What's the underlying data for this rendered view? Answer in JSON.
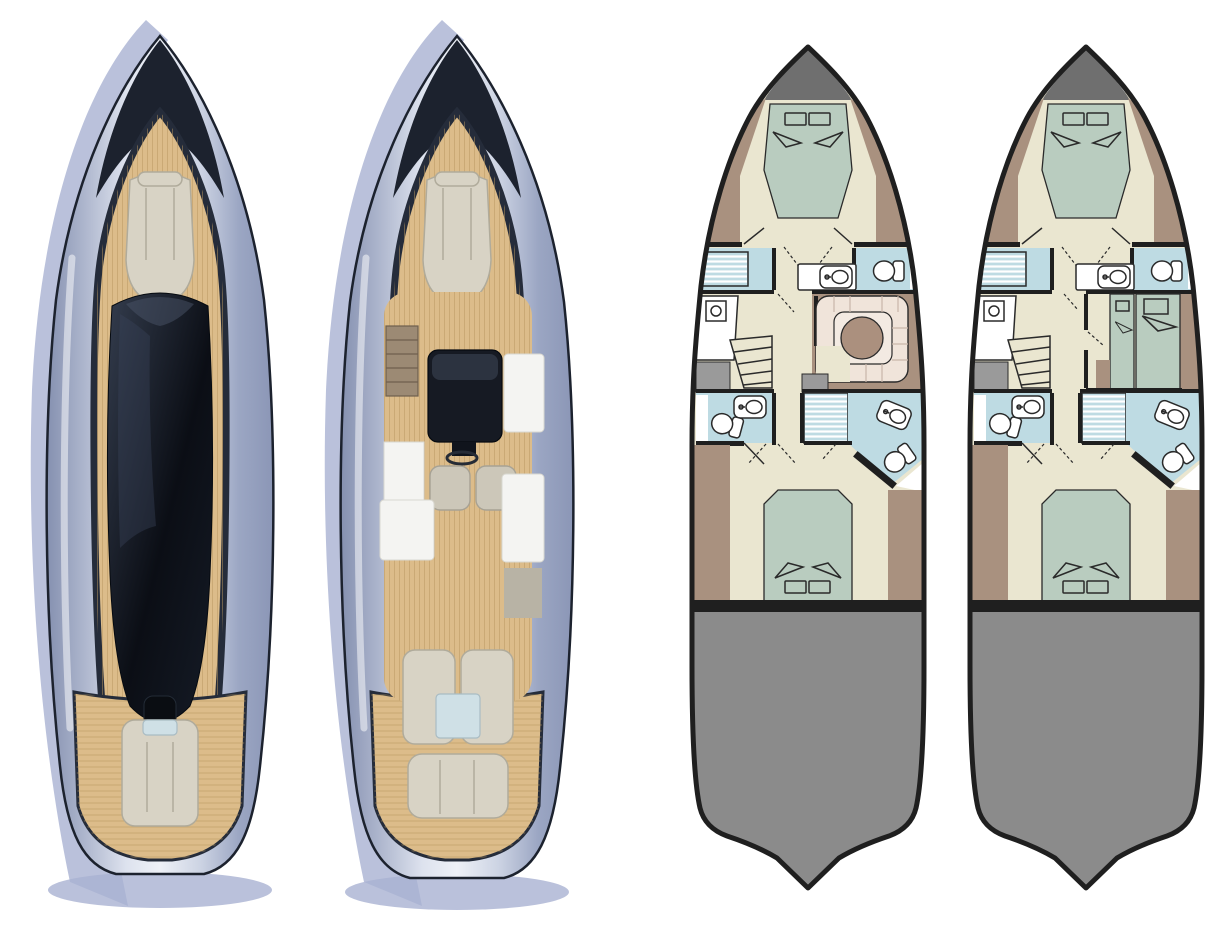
{
  "canvas": {
    "width": 1222,
    "height": 939
  },
  "colors": {
    "bg": "#ffffff",
    "white": "#ffffff",
    "hull_shadow": "#a9b2d2",
    "trim_dark": "#1c222e",
    "deck_teak": "#dcbc8a",
    "deck_plank_line": "#b8965f",
    "seat_beige": "#d8d3c5",
    "seat_shadow": "#b0ab9b",
    "cushion_blue": "#cfe0e6",
    "helm_dark": "#161a23",
    "interior_white": "#f4f4f2",
    "roof_black": "#0d1016",
    "roof_sheen": "#39435a",
    "plan_wall": "#1f1f1f",
    "plan_line": "#2a2a2a",
    "floor_cream": "#eae6d0",
    "bed_sage": "#b9ccbf",
    "deck_taupe": "#a9917f",
    "bath_blue": "#bedbe3",
    "bench_pink": "#f0e4da",
    "bench_line": "#c9b6aa",
    "table_brown": "#ab907e",
    "bow_gray": "#6f6f6f",
    "block_gray": "#9a9a9a",
    "engine_gray": "#8b8b8b"
  },
  "figures": {
    "render_hardtop_closed": {
      "kind": "3d-top-view-render",
      "features": [
        "hardtop-roof",
        "bow-seat",
        "aft-bench",
        "teak-side-decks",
        "aft-teak-deck",
        "hull-shadow"
      ]
    },
    "render_interior_open": {
      "kind": "3d-top-view-render",
      "features": [
        "open-cockpit",
        "companionway-stairs",
        "helm-console",
        "steering-wheel",
        "helm-seats",
        "galley-cabinets",
        "cockpit-table",
        "aft-lounge-chairs",
        "teak-decks",
        "hull-shadow"
      ]
    },
    "floorplan_option_a": {
      "kind": "lower-deck-floorplan",
      "rooms": [
        "bow-locker",
        "owner-cabin-forward",
        "shower-port-forward",
        "head-starboard-forward",
        "vanity",
        "galley-port",
        "companionway-stairs",
        "u-shaped-dinette-with-table",
        "head-port-aft",
        "shower-starboard-aft",
        "head-starboard-aft",
        "guest-cabin-aft",
        "engine-room"
      ]
    },
    "floorplan_option_b": {
      "kind": "lower-deck-floorplan",
      "rooms": [
        "bow-locker",
        "owner-cabin-forward",
        "shower-port-forward",
        "head-starboard-forward",
        "vanity",
        "galley-port",
        "companionway-stairs",
        "twin-guest-cabin-starboard",
        "head-port-aft",
        "shower-starboard-aft",
        "head-starboard-aft",
        "guest-cabin-aft",
        "engine-room"
      ]
    }
  }
}
